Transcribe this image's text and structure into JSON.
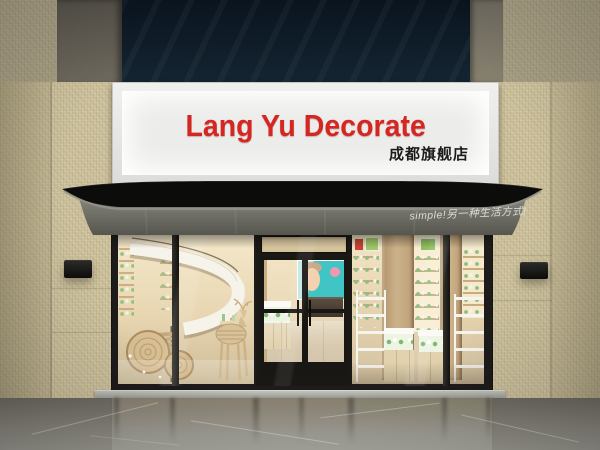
{
  "signboard": {
    "title": "Lang Yu Decorate",
    "subtitle": "成都旗舰店",
    "title_color": "#d52722",
    "subtitle_color": "#1c1c1c"
  },
  "awning": {
    "slogan": "simple!另一种生活方式!",
    "slogan_color": "#e8e6e0"
  },
  "palette": {
    "wall_tile": "#cdc29e",
    "top_panel_navy": "#0d1b26",
    "awning_roof_black": "#0c0c0b",
    "awning_valance_gray": "#6f6f68",
    "storefront_frame_black": "#1d1c1a",
    "interior_warm_beige": "#f0e2c2",
    "product_mint_green": "#8fbf83",
    "poster_teal": "#41c4c4",
    "sign_face_white": "#ececea",
    "floor_gray": "#9c9a92"
  }
}
